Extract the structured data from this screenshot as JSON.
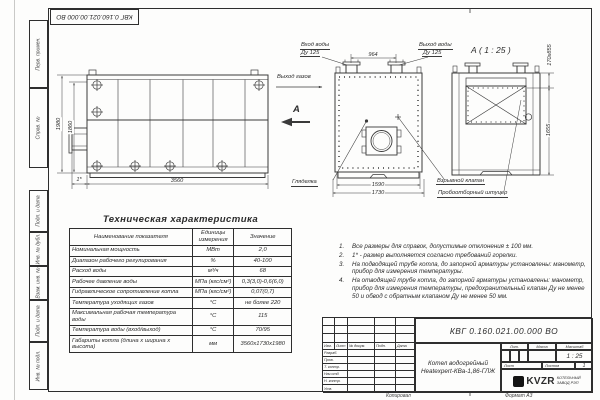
{
  "stamp_top": "КВГ 0.160.021.00.000 ВО",
  "margin": {
    "cells_top": [
      "Перв. примен.",
      "Справ. №"
    ],
    "cells_bottom": [
      "Подп. и дата",
      "Инв. № дубл.",
      "Взам. инв. №",
      "Подп. и дата",
      "Инв. № подл."
    ]
  },
  "side_view": {
    "dim_h_outer": "1980",
    "dim_h_inner": "1860",
    "dim_length": "3560",
    "dim_burner": "1*"
  },
  "front_view": {
    "water_in_1": "Вход воды",
    "water_in_2": "Ду 125",
    "water_out_1": "Выход воды",
    "water_out_2": "Ду 125",
    "gas_out": "Выход газов",
    "view_letter": "А",
    "dim_top": "964",
    "dim_inner": "1590",
    "dim_outer": "1730",
    "sight_glass": "Гляделка"
  },
  "detail_view": {
    "title": "А ( 1 : 25 )",
    "dim_top": "170х855",
    "dim_height": "1655",
    "explosion_valve": "Взрывной клапан",
    "sampler": "Пробоотборный штуцер"
  },
  "spec_table": {
    "title": "Техническая характеристика",
    "headers": [
      "Наименование показателя",
      "Единицы измерения",
      "Значение"
    ],
    "rows": [
      [
        "Номинальная мощность",
        "МВт",
        "2,0"
      ],
      [
        "Диапазон рабочего регулирования",
        "%",
        "40-100"
      ],
      [
        "Расход воды",
        "м³/ч",
        "68"
      ],
      [
        "Рабочее давление воды",
        "МПа (кгс/см²)",
        "0,3(3,0)-0,6(6,0)"
      ],
      [
        "Гидравлическое сопротивление котла",
        "МПа (кгс/см²)",
        "0,07(0,7)"
      ],
      [
        "Температура уходящих газов",
        "°С",
        "не более 220"
      ],
      [
        "Максимальная рабочая температура воды",
        "°С",
        "115"
      ],
      [
        "Температура воды (вход/выход)",
        "°С",
        "70/95"
      ],
      [
        "Габариты котла (длина х ширина х высота)",
        "мм",
        "3560х1730х1980"
      ]
    ]
  },
  "notes": {
    "items": [
      {
        "num": "1.",
        "text": "Все размеры для справок, допустимые отклонения ± 100 мм."
      },
      {
        "num": "2.",
        "text": "1* - размер выполняется согласно требований горелки."
      },
      {
        "num": "3.",
        "text": "На подводящей трубе котла, до запорной арматуры установлены: манометр, прибор для измерения температуры."
      },
      {
        "num": "4.",
        "text": "На отводящей трубе котла, до запорной арматуры установлены: манометр, прибор для измерения температуры, предохранительный клапан Ду не менее 50 и обвод с обратным клапаном Ду не менее 50 мм."
      }
    ]
  },
  "title_block": {
    "doc_number": "КВГ 0.160.021.00.000 ВО",
    "name_line1": "Котел водогрейный",
    "name_line2": "Heatexpert-КВа-1,86-ГЛЖ",
    "header_cells": [
      "Изм.",
      "Лист",
      "№ докум.",
      "Подп.",
      "Дата"
    ],
    "left_rows": [
      "Разраб.",
      "Пров.",
      "Т. контр.",
      "Нач.отд.",
      "Н. контр.",
      "Утв."
    ],
    "lit_label": "Лит.",
    "mass_label": "Масса",
    "scale_label": "Масштаб",
    "scale_value": "1 : 25",
    "sheet_label": "Лист",
    "sheets_label": "Листов",
    "sheets_value": "1",
    "logo_text": "KVZR",
    "company_line1": "КОТЕЛЬНЫЙ",
    "company_line2": "ЗАВОД РЭП",
    "footer_copy": "Копировал",
    "footer_format": "Формат А3"
  }
}
